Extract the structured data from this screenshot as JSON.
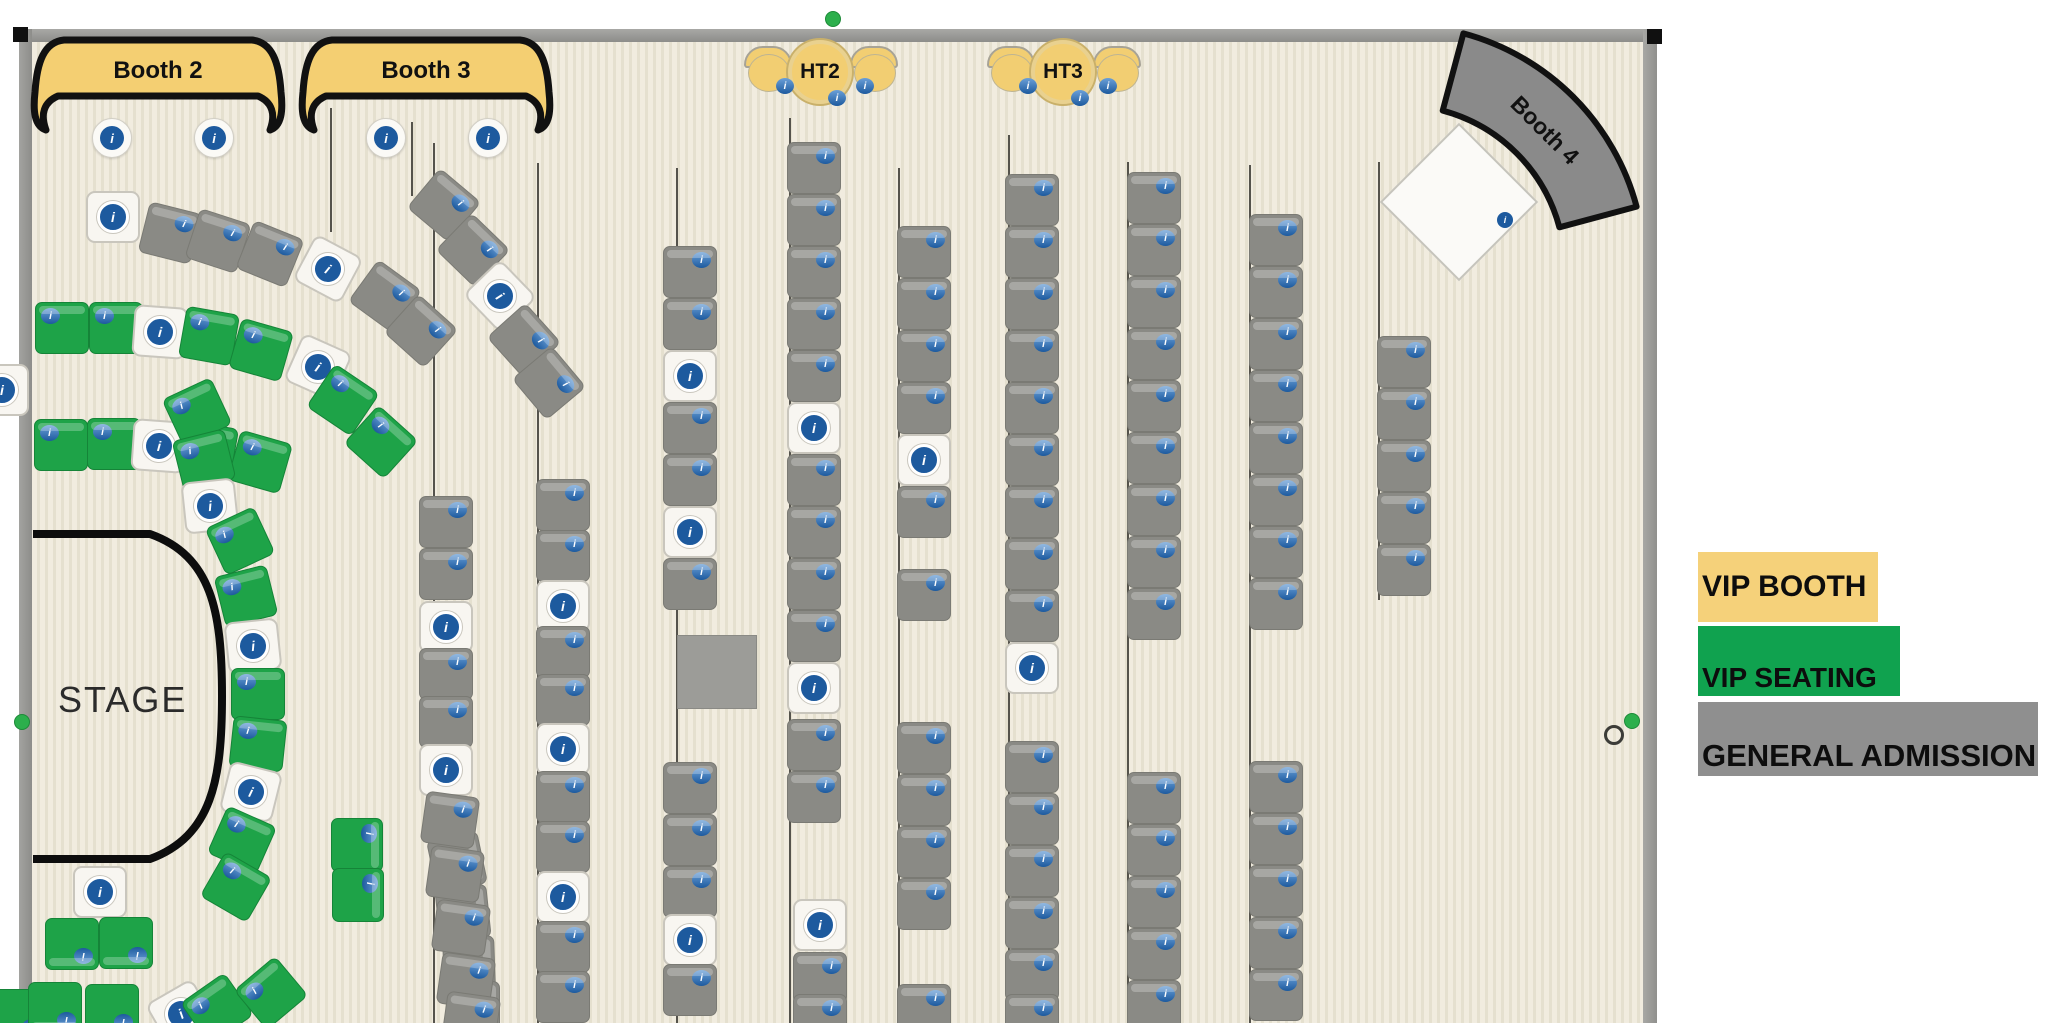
{
  "stage": {
    "label": "STAGE"
  },
  "booths": [
    {
      "label": "Booth 2"
    },
    {
      "label": "Booth 3"
    },
    {
      "label": "Booth 4"
    }
  ],
  "tables": [
    {
      "label": "HT2"
    },
    {
      "label": "HT3"
    }
  ],
  "legend": {
    "items": [
      {
        "label": "VIP BOOTH",
        "color": "#f5d17a",
        "x": 1698,
        "y": 552,
        "w": 180,
        "h": 70,
        "align": "center"
      },
      {
        "label": "VIP SEATING",
        "color": "#10a24f",
        "x": 1698,
        "y": 626,
        "w": 202,
        "h": 70,
        "align": "end"
      },
      {
        "label": "GENERAL ADMISSION",
        "color": "#8f8f8f",
        "x": 1698,
        "y": 702,
        "w": 340,
        "h": 74,
        "align": "end"
      }
    ]
  },
  "seat_colors": {
    "general": "#8a8a85",
    "vip": "#1ea348",
    "unassigned": "#f8f6f1",
    "badge_blue": "#1d5a9e"
  },
  "seats": [
    [
      113,
      217,
      0,
      "w"
    ],
    [
      170,
      233,
      14,
      "g"
    ],
    [
      218,
      241,
      18,
      "g"
    ],
    [
      270,
      254,
      22,
      "g"
    ],
    [
      328,
      269,
      28,
      "w"
    ],
    [
      385,
      296,
      36,
      "g"
    ],
    [
      421,
      331,
      42,
      "g"
    ],
    [
      444,
      205,
      40,
      "g"
    ],
    [
      473,
      250,
      44,
      "g"
    ],
    [
      500,
      296,
      46,
      "w"
    ],
    [
      524,
      340,
      48,
      "g"
    ],
    [
      549,
      383,
      50,
      "g"
    ],
    [
      62,
      328,
      0,
      "v"
    ],
    [
      116,
      328,
      0,
      "v"
    ],
    [
      160,
      332,
      4,
      "w"
    ],
    [
      209,
      336,
      10,
      "v"
    ],
    [
      261,
      350,
      16,
      "v"
    ],
    [
      318,
      367,
      24,
      "w"
    ],
    [
      343,
      400,
      34,
      "v"
    ],
    [
      381,
      442,
      42,
      "v"
    ],
    [
      61,
      445,
      0,
      "v"
    ],
    [
      114,
      444,
      0,
      "v"
    ],
    [
      159,
      446,
      4,
      "w"
    ],
    [
      208,
      450,
      10,
      "v"
    ],
    [
      260,
      462,
      16,
      "v"
    ],
    [
      2,
      390,
      0,
      "w"
    ],
    [
      197,
      412,
      -25,
      "v"
    ],
    [
      204,
      460,
      -14,
      "v"
    ],
    [
      210,
      506,
      -6,
      "w"
    ],
    [
      240,
      541,
      -25,
      "v"
    ],
    [
      246,
      596,
      -14,
      "v"
    ],
    [
      253,
      646,
      -6,
      "w"
    ],
    [
      258,
      694,
      0,
      "v"
    ],
    [
      258,
      744,
      6,
      "v"
    ],
    [
      251,
      792,
      14,
      "w"
    ],
    [
      242,
      840,
      24,
      "v"
    ],
    [
      236,
      887,
      30,
      "v"
    ],
    [
      100,
      892,
      0,
      "w"
    ],
    [
      72,
      944,
      180,
      "v"
    ],
    [
      126,
      943,
      180,
      "v"
    ],
    [
      20,
      1015,
      180,
      "v"
    ],
    [
      55,
      1008,
      180,
      "v"
    ],
    [
      112,
      1010,
      180,
      "v"
    ],
    [
      181,
      1014,
      -30,
      "w"
    ],
    [
      217,
      1009,
      -35,
      "v"
    ],
    [
      271,
      993,
      -40,
      "v"
    ],
    [
      357,
      845,
      90,
      "v"
    ],
    [
      358,
      895,
      90,
      "v"
    ],
    [
      457,
      862,
      78,
      "g"
    ],
    [
      463,
      913,
      84,
      "g"
    ],
    [
      469,
      963,
      88,
      "g"
    ],
    [
      474,
      1008,
      90,
      "g"
    ],
    [
      446,
      522,
      0,
      "g"
    ],
    [
      446,
      574,
      0,
      "g"
    ],
    [
      446,
      627,
      0,
      "w"
    ],
    [
      446,
      674,
      0,
      "g"
    ],
    [
      446,
      722,
      0,
      "g"
    ],
    [
      446,
      770,
      0,
      "w"
    ],
    [
      450,
      820,
      8,
      "g"
    ],
    [
      455,
      874,
      8,
      "g"
    ],
    [
      461,
      928,
      8,
      "g"
    ],
    [
      466,
      981,
      8,
      "g"
    ],
    [
      471,
      1020,
      8,
      "g"
    ],
    [
      563,
      505,
      0,
      "g"
    ],
    [
      563,
      556,
      0,
      "g"
    ],
    [
      563,
      606,
      0,
      "w"
    ],
    [
      563,
      652,
      0,
      "g"
    ],
    [
      563,
      700,
      0,
      "g"
    ],
    [
      563,
      749,
      0,
      "w"
    ],
    [
      563,
      797,
      0,
      "g"
    ],
    [
      563,
      847,
      0,
      "g"
    ],
    [
      563,
      897,
      0,
      "w"
    ],
    [
      563,
      947,
      0,
      "g"
    ],
    [
      563,
      997,
      0,
      "g"
    ],
    [
      690,
      272,
      0,
      "g"
    ],
    [
      690,
      324,
      0,
      "g"
    ],
    [
      690,
      376,
      0,
      "w"
    ],
    [
      690,
      428,
      0,
      "g"
    ],
    [
      690,
      480,
      0,
      "g"
    ],
    [
      690,
      532,
      0,
      "w"
    ],
    [
      690,
      584,
      0,
      "g"
    ],
    [
      690,
      788,
      0,
      "g"
    ],
    [
      690,
      840,
      0,
      "g"
    ],
    [
      690,
      892,
      0,
      "g"
    ],
    [
      690,
      940,
      0,
      "w"
    ],
    [
      690,
      990,
      0,
      "g"
    ],
    [
      814,
      168,
      0,
      "g"
    ],
    [
      814,
      220,
      0,
      "g"
    ],
    [
      814,
      272,
      0,
      "g"
    ],
    [
      814,
      324,
      0,
      "g"
    ],
    [
      814,
      376,
      0,
      "g"
    ],
    [
      814,
      428,
      0,
      "w"
    ],
    [
      814,
      480,
      0,
      "g"
    ],
    [
      814,
      532,
      0,
      "g"
    ],
    [
      814,
      584,
      0,
      "g"
    ],
    [
      814,
      636,
      0,
      "g"
    ],
    [
      814,
      688,
      0,
      "w"
    ],
    [
      814,
      745,
      0,
      "g"
    ],
    [
      814,
      797,
      0,
      "g"
    ],
    [
      820,
      925,
      0,
      "w"
    ],
    [
      820,
      978,
      0,
      "g"
    ],
    [
      820,
      1020,
      0,
      "g"
    ],
    [
      924,
      252,
      0,
      "g"
    ],
    [
      924,
      304,
      0,
      "g"
    ],
    [
      924,
      356,
      0,
      "g"
    ],
    [
      924,
      408,
      0,
      "g"
    ],
    [
      924,
      460,
      0,
      "w"
    ],
    [
      924,
      512,
      0,
      "g"
    ],
    [
      924,
      595,
      0,
      "g"
    ],
    [
      924,
      748,
      0,
      "g"
    ],
    [
      924,
      800,
      0,
      "g"
    ],
    [
      924,
      852,
      0,
      "g"
    ],
    [
      924,
      904,
      0,
      "g"
    ],
    [
      924,
      1010,
      0,
      "g"
    ],
    [
      1032,
      200,
      0,
      "g"
    ],
    [
      1032,
      252,
      0,
      "g"
    ],
    [
      1032,
      304,
      0,
      "g"
    ],
    [
      1032,
      356,
      0,
      "g"
    ],
    [
      1032,
      408,
      0,
      "g"
    ],
    [
      1032,
      460,
      0,
      "g"
    ],
    [
      1032,
      512,
      0,
      "g"
    ],
    [
      1032,
      564,
      0,
      "g"
    ],
    [
      1032,
      616,
      0,
      "g"
    ],
    [
      1032,
      668,
      0,
      "w"
    ],
    [
      1032,
      767,
      0,
      "g"
    ],
    [
      1032,
      819,
      0,
      "g"
    ],
    [
      1032,
      871,
      0,
      "g"
    ],
    [
      1032,
      923,
      0,
      "g"
    ],
    [
      1032,
      975,
      0,
      "g"
    ],
    [
      1032,
      1020,
      0,
      "g"
    ],
    [
      1154,
      198,
      0,
      "g"
    ],
    [
      1154,
      250,
      0,
      "g"
    ],
    [
      1154,
      302,
      0,
      "g"
    ],
    [
      1154,
      354,
      0,
      "g"
    ],
    [
      1154,
      406,
      0,
      "g"
    ],
    [
      1154,
      458,
      0,
      "g"
    ],
    [
      1154,
      510,
      0,
      "g"
    ],
    [
      1154,
      562,
      0,
      "g"
    ],
    [
      1154,
      614,
      0,
      "g"
    ],
    [
      1154,
      798,
      0,
      "g"
    ],
    [
      1154,
      850,
      0,
      "g"
    ],
    [
      1154,
      902,
      0,
      "g"
    ],
    [
      1154,
      954,
      0,
      "g"
    ],
    [
      1154,
      1006,
      0,
      "g"
    ],
    [
      1276,
      240,
      0,
      "g"
    ],
    [
      1276,
      292,
      0,
      "g"
    ],
    [
      1276,
      344,
      0,
      "g"
    ],
    [
      1276,
      396,
      0,
      "g"
    ],
    [
      1276,
      448,
      0,
      "g"
    ],
    [
      1276,
      500,
      0,
      "g"
    ],
    [
      1276,
      552,
      0,
      "g"
    ],
    [
      1276,
      604,
      0,
      "g"
    ],
    [
      1276,
      787,
      0,
      "g"
    ],
    [
      1276,
      839,
      0,
      "g"
    ],
    [
      1276,
      891,
      0,
      "g"
    ],
    [
      1276,
      943,
      0,
      "g"
    ],
    [
      1276,
      995,
      0,
      "g"
    ],
    [
      1404,
      362,
      0,
      "g"
    ],
    [
      1404,
      414,
      0,
      "g"
    ],
    [
      1404,
      466,
      0,
      "g"
    ],
    [
      1404,
      518,
      0,
      "g"
    ],
    [
      1404,
      570,
      0,
      "g"
    ]
  ],
  "guide_lines": [
    [
      433,
      143,
      1023
    ],
    [
      537,
      163,
      1023
    ],
    [
      676,
      168,
      1023
    ],
    [
      789,
      118,
      1023
    ],
    [
      898,
      168,
      1023
    ],
    [
      1008,
      135,
      1023
    ],
    [
      1127,
      162,
      1023
    ],
    [
      1249,
      165,
      1023
    ],
    [
      1378,
      162,
      600
    ],
    [
      330,
      108,
      232
    ],
    [
      411,
      122,
      196
    ]
  ],
  "booth_info_circles": [
    [
      111,
      137
    ],
    [
      213,
      137
    ],
    [
      385,
      137
    ],
    [
      487,
      137
    ]
  ],
  "gray_square": {
    "x": 677,
    "y": 635,
    "w": 78,
    "h": 72
  },
  "diamond_table": {
    "cx": 1457,
    "cy": 200,
    "dot_x": 1505,
    "dot_y": 220
  },
  "ht_groups": [
    {
      "label": "HT2",
      "cx": 820,
      "cy": 72
    },
    {
      "label": "HT3",
      "cx": 1063,
      "cy": 72
    }
  ],
  "handles": {
    "black_squares": [
      [
        13,
        27
      ],
      [
        1647,
        29
      ]
    ],
    "green_dots": [
      [
        825,
        11
      ],
      [
        14,
        714
      ],
      [
        1624,
        713
      ]
    ],
    "open_circle": [
      1604,
      725
    ]
  }
}
